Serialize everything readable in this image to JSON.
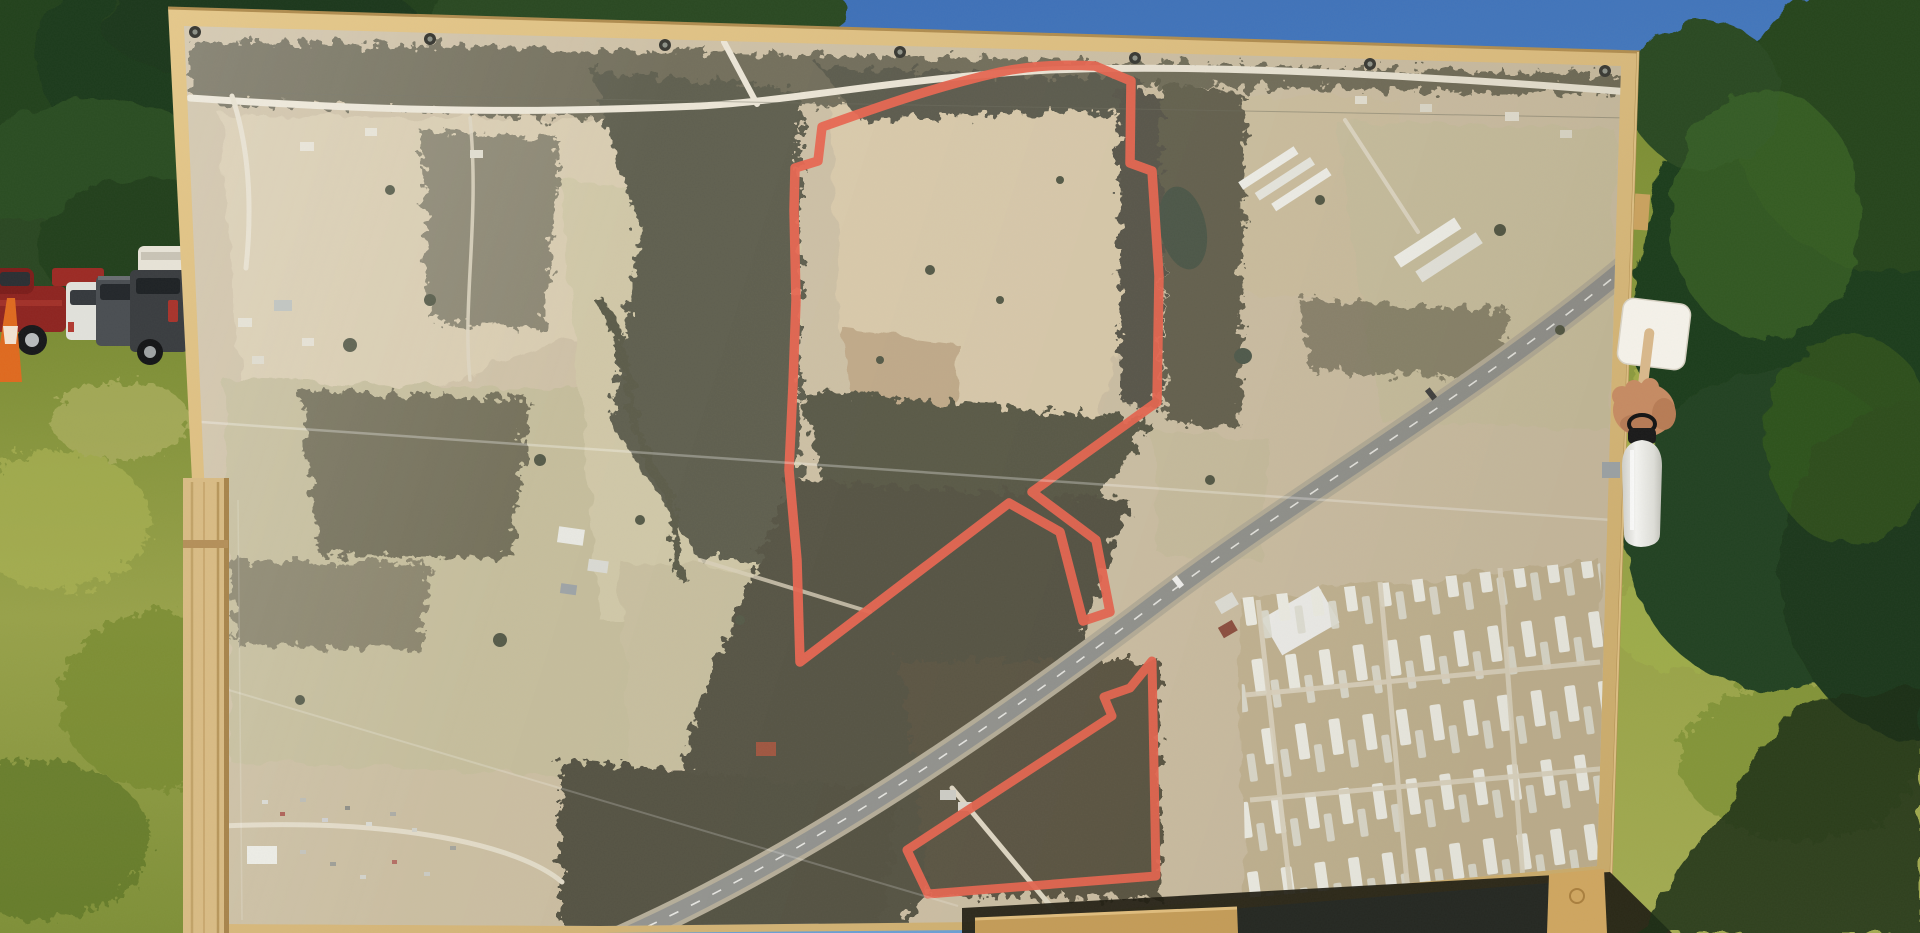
{
  "scene": {
    "title": "Land sale aerial map sign in a field",
    "description": "Photograph of a large vinyl banner showing an aerial/satellite map with red-outlined land parcels, mounted on a plywood board with wooden frame legs, standing in a sunlit grass field with trees behind, parked trucks at left, and a person's hand holding a white paddle fan and a white bottle at the right edge of the board.",
    "setting": "outdoor, sunny day"
  },
  "background": {
    "sky_label": "blue sky",
    "sky_color": "#4a79b5",
    "trees_label": "tree line",
    "trees_color": "#24421f",
    "grass_label": "sunlit grass field",
    "grass_color": "#94a043",
    "shadow_label": "sign shadow on grass",
    "vehicles": [
      {
        "label": "red pickup truck",
        "color": "#8e2420"
      },
      {
        "label": "white SUV",
        "color": "#e2e2dc"
      },
      {
        "label": "dark gray SUV",
        "color": "#4a4e52"
      },
      {
        "label": "charcoal pickup with red taillight",
        "color": "#3a3d40"
      },
      {
        "label": "white utility trailer",
        "color": "#e8e4d8"
      },
      {
        "label": "orange traffic cone",
        "color": "#e06a1f"
      }
    ]
  },
  "board": {
    "label": "plywood sign board with vinyl aerial-map banner",
    "wood_color": "#d9ba7d",
    "banner_base_color": "#cdbfa3",
    "grommets_label": "metal banner grommets",
    "crease_label": "banner crease lines"
  },
  "map": {
    "type_label": "aerial / satellite imagery",
    "parcel_outline_label": "red surveyed parcel boundaries",
    "parcel_outline_color": "#e8604a",
    "features": [
      {
        "label": "main flag-shaped parcel with access corridor to highway"
      },
      {
        "label": "second wooded parcel south of highway"
      },
      {
        "label": "divided highway running diagonally",
        "color": "#8f908c"
      },
      {
        "label": "winding county road along top",
        "color": "#ece6d6"
      },
      {
        "label": "large cleared field inside main parcel",
        "color": "#d9c9a9"
      },
      {
        "label": "dense forest blocks",
        "color": "#585747"
      },
      {
        "label": "pond east of parcel",
        "color": "#465243"
      },
      {
        "label": "poultry barns and white farm buildings",
        "color": "#f2f2ec"
      },
      {
        "label": "mobile home park grid at lower right",
        "color": "#f2f2ea"
      },
      {
        "label": "salvage yard cluster at lower left"
      }
    ]
  },
  "foreground": {
    "paddle_label": "white hand-fan paddle with wooden stick",
    "paddle_color": "#f5f2ea",
    "hand_label": "hand gripping paddle",
    "skin_color": "#c68b63",
    "bottle_label": "white insulated water bottle with black cap",
    "bottle_color": "#efefec",
    "frame_leg_label": "wooden frame legs and bottom rail",
    "frame_wood_color": "#cfa660"
  }
}
